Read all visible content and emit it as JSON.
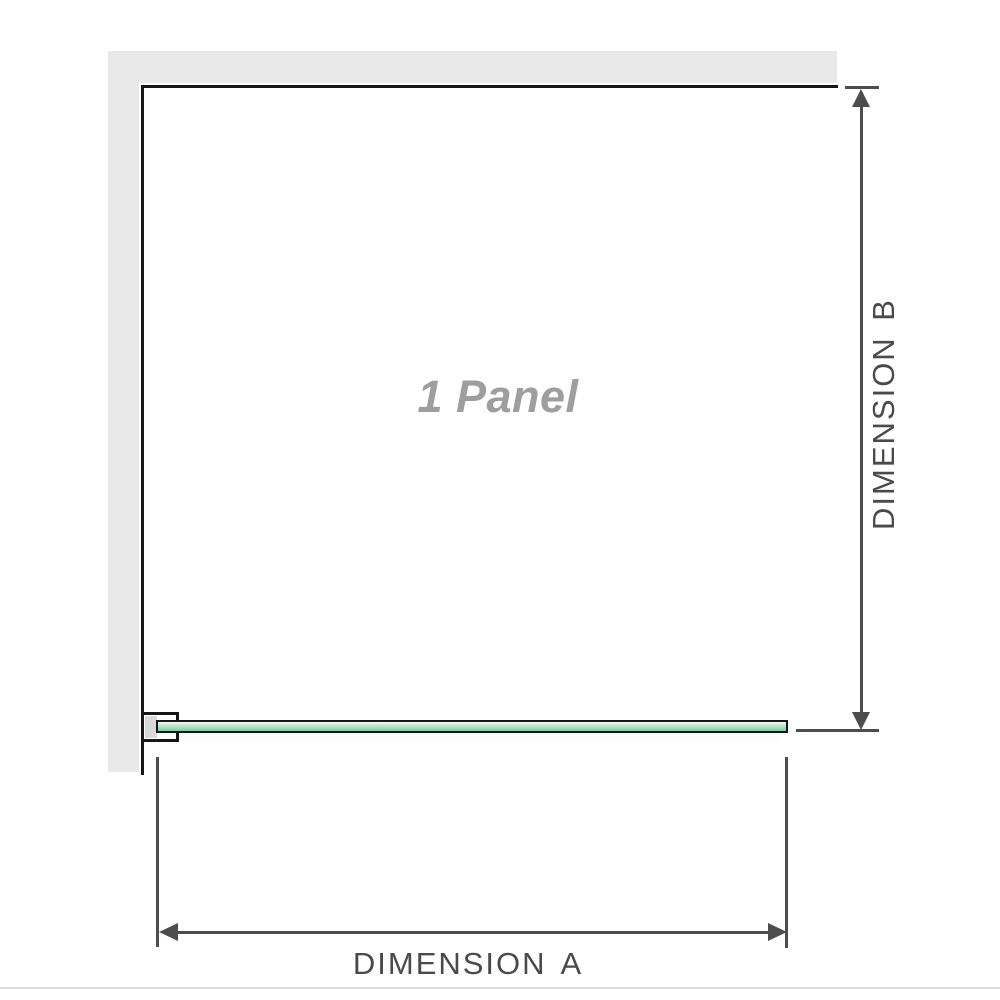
{
  "labels": {
    "panel": "1 Panel",
    "dimension_a": "DIMENSION A",
    "dimension_b": "DIMENSION B"
  },
  "colors": {
    "background": "#ffffff",
    "wall": "#e9e9e9",
    "edge_line": "#161616",
    "dim_line": "#4d4d4d",
    "dim_text": "#4a4a4a",
    "panel_text": "#9e9e9e",
    "glass_border": "#161616",
    "glass_light": "#f2faf5",
    "glass_mid": "#abdfc4",
    "glass_dark": "#7fcaa2",
    "bracket_fill": "#d9d9d9",
    "page_rule": "#e1e0dc"
  }
}
